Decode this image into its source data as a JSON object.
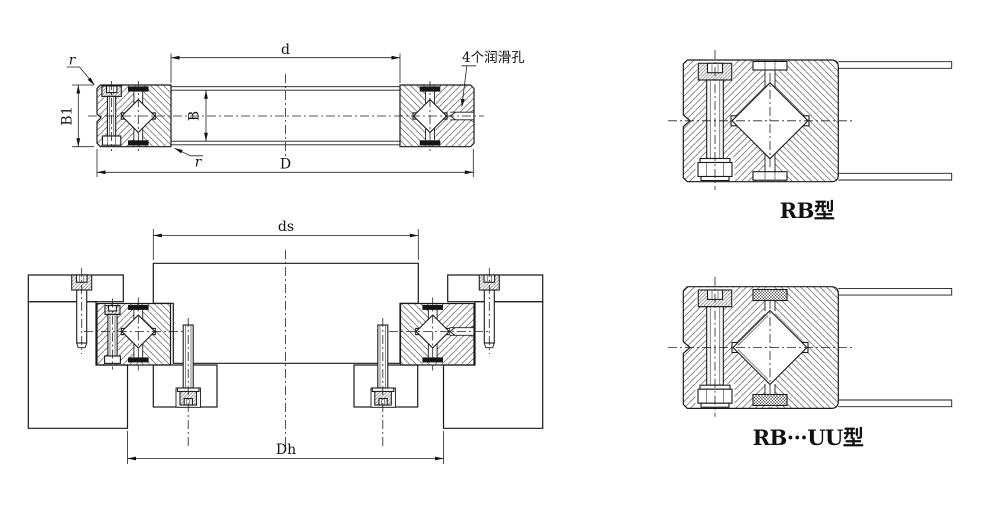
{
  "labels": {
    "dim_d": "d",
    "dim_D": "D",
    "dim_B": "B",
    "dim_B1": "B1",
    "radius_top": "r",
    "radius_bottom": "r",
    "lube_note": "4个润滑孔",
    "dim_ds": "ds",
    "dim_Dh": "Dh",
    "rb_type": "RB型",
    "rbuu_type": "RB···UU型"
  },
  "colors": {
    "line": "#1a1a1a",
    "hatch": "#565656",
    "cage_fill": "#151515",
    "background": "#ffffff"
  }
}
